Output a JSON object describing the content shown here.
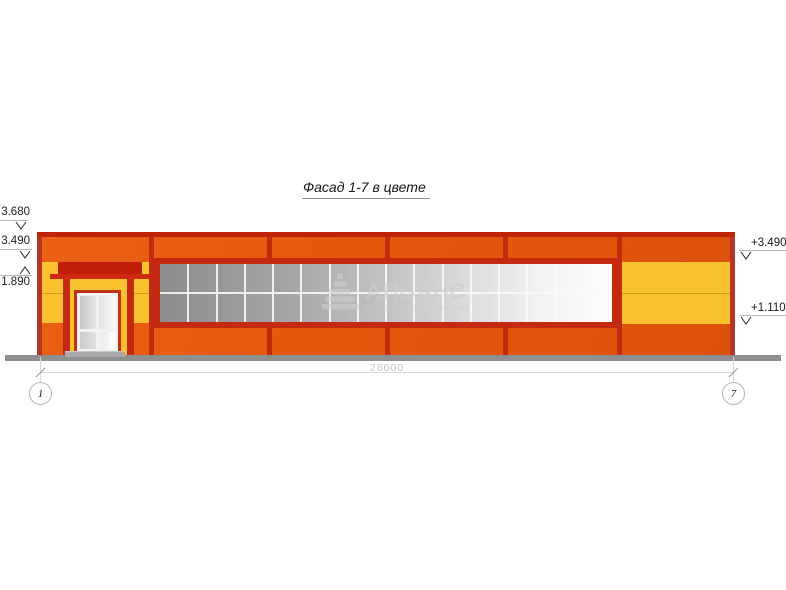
{
  "title": "Фасад 1-7 в цвете",
  "elevation_marks": {
    "left": [
      {
        "label": "3.680"
      },
      {
        "label": "3.490"
      },
      {
        "label": "1.890"
      }
    ],
    "right": [
      {
        "label": "+3.490"
      },
      {
        "label": "+1.110"
      }
    ]
  },
  "dimension": {
    "length_label": "26000"
  },
  "axes": [
    {
      "label": "1"
    },
    {
      "label": "7"
    }
  ],
  "watermark": {
    "name": "АЛЬЯНС",
    "subtitle": "строительная компания",
    "logo": "striped-pyramid"
  },
  "window_grid": {
    "cols": 16,
    "rows": 2
  },
  "colors": {
    "facade_orange": "#E4580E",
    "accent_red": "#C42A0F",
    "dark_red": "#BF2409",
    "corner_red": "#B53526",
    "panel_yellow": "#F9C22E",
    "ground_gray": "#8F8F8F",
    "glass_dark": "#8C8C8C",
    "glass_light": "#FDFDFD",
    "dim_gray": "#D8D8D8"
  }
}
